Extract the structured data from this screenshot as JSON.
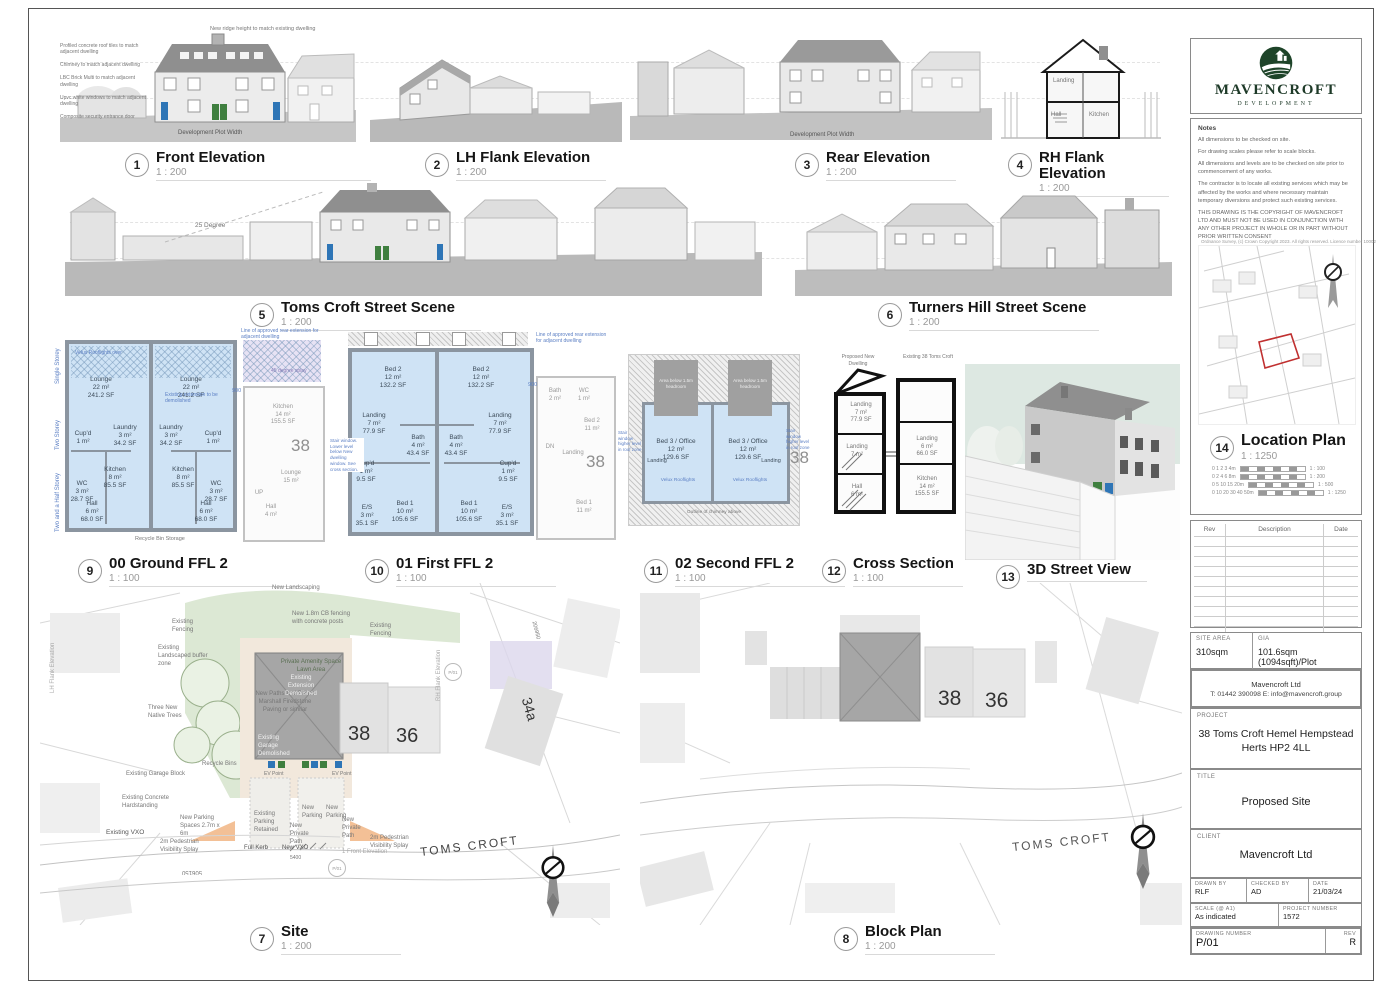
{
  "brand": {
    "name": "MAVENCROFT",
    "tagline": "DEVELOPMENT"
  },
  "notes": {
    "heading": "Notes",
    "items": [
      "All dimensions to be checked on site.",
      "For drawing scales please refer to scale blocks.",
      "All dimensions and levels are to be checked on site prior to commencement of any works.",
      "The contractor is to locate all existing services which may be affected by the works and where necessary maintain temporary diversions and protect such existing services.",
      "THIS DRAWING IS THE COPYRIGHT OF MAVENCROFT LTD AND MUST NOT BE USED IN CONJUNCTION WITH ANY OTHER PROJECT IN WHOLE OR IN PART WITHOUT PRIOR WRITTEN CONSENT"
    ]
  },
  "views": {
    "front": {
      "num": "1",
      "title": "Front Elevation",
      "scale": "1 : 200"
    },
    "lh": {
      "num": "2",
      "title": "LH Flank Elevation",
      "scale": "1 : 200"
    },
    "rear": {
      "num": "3",
      "title": "Rear Elevation",
      "scale": "1 : 200"
    },
    "rh": {
      "num": "4",
      "title": "RH Flank Elevation",
      "scale": "1 : 200"
    },
    "scene_toms": {
      "num": "5",
      "title": "Toms Croft Street Scene",
      "scale": "1 : 200"
    },
    "scene_turners": {
      "num": "6",
      "title": "Turners Hill Street Scene",
      "scale": "1 : 200"
    },
    "site": {
      "num": "7",
      "title": "Site",
      "scale": "1 : 200"
    },
    "block": {
      "num": "8",
      "title": "Block Plan",
      "scale": "1 : 200"
    },
    "ground": {
      "num": "9",
      "title": "00 Ground FFL 2",
      "scale": "1 : 100"
    },
    "first": {
      "num": "10",
      "title": "01 First FFL 2",
      "scale": "1 : 100"
    },
    "second": {
      "num": "11",
      "title": "02 Second FFL 2",
      "scale": "1 : 100"
    },
    "cross": {
      "num": "12",
      "title": "Cross Section",
      "scale": "1 : 100"
    },
    "view3d": {
      "num": "13",
      "title": "3D Street View",
      "scale": ""
    },
    "location": {
      "num": "14",
      "title": "Location Plan",
      "scale": "1 : 1250"
    }
  },
  "elevations": {
    "front_notes": [
      "Profiled concrete roof tiles to match adjacent dwelling",
      "Chimney to match adjacent dwelling",
      "LBC Brick Multi to match adjacent dwelling",
      "Upvc white windows to match adjacent dwelling",
      "Composite security entrance door"
    ],
    "ridge_note": "New ridge height to match existing dwelling",
    "plot_width": "Development Plot Width",
    "degree25": "25 Degree",
    "rh_rooms": [
      "Landing",
      "Hall",
      "Kitchen"
    ]
  },
  "plans": {
    "ground": {
      "rooms": [
        "Lounge\n22 m²\n241.2 SF",
        "Laundry\n3 m²\n34.2 SF",
        "Cup'd\n1 m²",
        "Kitchen\n8 m²\n85.5 SF",
        "WC\n3 m²\n28.7 SF",
        "Hall\n6 m²\n68.0 SF"
      ],
      "storeys": [
        "Single Storey",
        "Two Storey",
        "Two and a Half Storey"
      ],
      "ext_note": "Line of approved rear extension for adjacent dwelling",
      "splay_note": "45 degree splay",
      "gap": "900",
      "bins": "Recycle Bin Storage",
      "velux": "Velux Rooflights over",
      "demo_note": "Existing extension to be demolished",
      "neighbor_num": "38",
      "neighbor_rooms": [
        "Kitchen\n14 m²\n155.5 SF",
        "Lounge\n15 m²",
        "Hall\n4 m²",
        "UP"
      ]
    },
    "first": {
      "rooms": [
        "Bed 2\n12 m²\n132.2 SF",
        "Landing\n7 m²\n77.9 SF",
        "Bath\n4 m²\n43.4 SF",
        "Cup'd\n1 m²\n9.5 SF",
        "Bed 1\n10 m²\n105.6 SF",
        "E/S\n3 m²\n35.1 SF"
      ],
      "window_note": "Stair window. Lower level below New dwelling window. See cross section.",
      "gap": "900",
      "ext_note": "Line of approved rear extension for adjacent dwelling",
      "neighbor_num": "38",
      "neighbor_rooms": [
        "Bath\n2 m²",
        "WC\n1 m²",
        "Bed 2\n11 m²",
        "Landing",
        "Bed 1\n11 m²",
        "DN"
      ]
    },
    "second": {
      "room": "Bed 3 / Office\n12 m²\n129.6 SF",
      "headroom": "Area below 1.5m headroom",
      "velux": "Velux Rooflights",
      "landing": "Landing",
      "chimney": "Outline of chimney above",
      "window_note": "Stair window higher level in roof zone",
      "neighbor_num": "38"
    },
    "cross": {
      "col_left": "Proposed New Dwelling",
      "col_right": "Existing 38 Toms Croft",
      "rooms": [
        "Landing\n7 m²\n77.9 SF",
        "Landing\n7 m²",
        "Hall\n6 m²",
        "Landing\n6 m²\n66.0 SF",
        "Kitchen\n14 m²\n155.5 SF"
      ]
    }
  },
  "site": {
    "new_landscaping": "New Landscaping",
    "existing_fencing": "Existing Fencing",
    "cb_fencing": "New 1.8m CB fencing with concrete posts",
    "amenity": "Private Amenity Space Lawn Area",
    "paths": "New Paths and Patios Marshall Firedstone Paving or similar",
    "buffer": "Existing Landscaped buffer zone",
    "trees": "Three New Native Trees",
    "garage_block": "Existing Garage Block",
    "ext_demolished": "Existing Extension Demolished",
    "garage_demolished": "Existing Garage Demolished",
    "recycle": "Recycle Bins",
    "ev": "EV Point",
    "hardstanding": "Existing Concrete Hardstanding",
    "parking_spaces": "New Parking Spaces 2.7m x 6m",
    "parking_retained": "Existing Parking Retained",
    "private_path": "New Private Path",
    "new_parking": "New Parking",
    "splay": "2m Pedestrian Visibility Splay",
    "vxo_existing": "Existing VXO",
    "full_kerb": "Full Kerb",
    "vxo_new": "New VXO",
    "dim_5400": "5400",
    "front_ref": "1 Front Elevation",
    "street": "TOMS CROFT",
    "no38": "38",
    "no36": "36",
    "no34a": "34a",
    "dim_506150": "506150",
    "grid_206950": "206950",
    "marker": "P/01",
    "lh_ref": "LH Flank Elevation",
    "rh_ref": "RH Flank Elevation"
  },
  "block": {
    "no38": "38",
    "no36": "36",
    "street": "TOMS CROFT"
  },
  "location": {
    "os_text": "Ordnance Survey, (c) Crown Copyright 2023. All rights reserved. Licence number 10002",
    "scalebars": [
      {
        "t": "0     1     2     3     4m",
        "r": "1 : 100"
      },
      {
        "t": "0     2     4     6     8m",
        "r": "1 : 200"
      },
      {
        "t": "0     5     10    15    20m",
        "r": "1 : 500"
      },
      {
        "t": "0   10   20   30   40   50m",
        "r": "1 : 1250"
      }
    ]
  },
  "titleblock": {
    "rev_table": {
      "col_rev": "Rev",
      "col_desc": "Description",
      "col_date": "Date"
    },
    "site_area_label": "SITE AREA",
    "site_area": "310sqm",
    "gia_label": "GIA",
    "gia": "101.6sqm (1094sqft)/Plot",
    "contact_line1": "Mavencroft Ltd",
    "contact_line2": "T: 01442 390098 E: info@mavencroft.group",
    "project_label": "PROJECT",
    "project": "38 Toms Croft Hemel Hempstead\nHerts HP2 4LL",
    "title_label": "TITLE",
    "title": "Proposed Site",
    "client_label": "CLIENT",
    "client": "Mavencroft Ltd",
    "drawn_label": "DRAWN BY",
    "drawn": "RLF",
    "checked_label": "CHECKED BY",
    "checked": "AD",
    "date_label": "DATE",
    "date": "21/03/24",
    "scale_label": "SCALE (@ A1)",
    "scale": "As indicated",
    "projnum_label": "PROJECT NUMBER",
    "projnum": "1572",
    "drawingnum_label": "DRAWING NUMBER",
    "drawingnum": "P/01",
    "rev_label": "REV",
    "rev": "R"
  }
}
